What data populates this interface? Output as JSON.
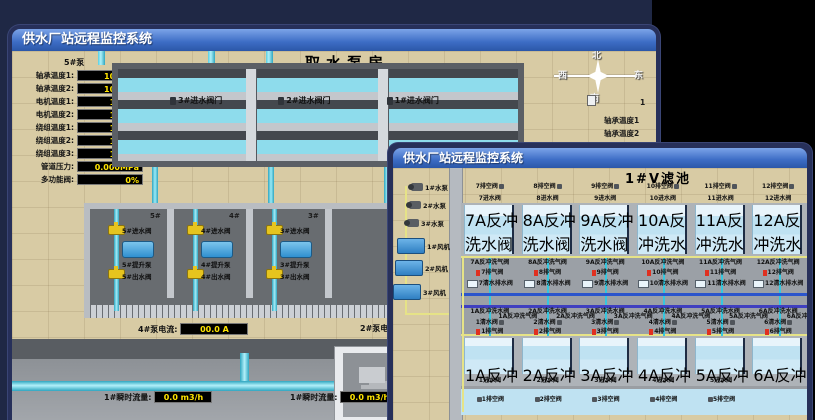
{
  "back_window": {
    "title": "供水厂站远程监控系统",
    "scene_title": "取水泵房",
    "pump_panel": {
      "header": "5#泵",
      "rows": [
        {
          "label": "轴承温度1:",
          "value": "100.0℃"
        },
        {
          "label": "轴承温度2:",
          "value": "100.0℃"
        },
        {
          "label": "电机温度1:",
          "value": "18.1℃"
        },
        {
          "label": "电机温度2:",
          "value": "17.9℃"
        },
        {
          "label": "绕组温度1:",
          "value": "18.0℃"
        },
        {
          "label": "绕组温度2:",
          "value": "18.1℃"
        },
        {
          "label": "绕组温度3:",
          "value": "18.1℃"
        },
        {
          "label": "管道压力:",
          "value": "0.000MPa"
        },
        {
          "label": "多功能阀:",
          "value": "0%"
        }
      ]
    },
    "tank_valves": [
      "3#进水阀门",
      "2#进水阀门",
      "1#进水阀门"
    ],
    "bay_headers": [
      "5#",
      "4#",
      "3#",
      "2#"
    ],
    "bays": [
      {
        "inlet": "5#进水阀",
        "pump": "5#提升泵",
        "outlet": "5#出水阀"
      },
      {
        "inlet": "4#进水阀",
        "pump": "4#提升泵",
        "outlet": "4#出水阀"
      },
      {
        "inlet": "3#进水阀",
        "pump": "3#提升泵",
        "outlet": "3#出水阀"
      }
    ],
    "current": {
      "left_label": "4#泵电流:",
      "left_value": "00.0 A",
      "right_label": "2#泵电流:"
    },
    "flows": [
      {
        "label": "1#瞬时流量:",
        "value": "0.0 m3/h"
      },
      {
        "label": "1#瞬时流量:",
        "value": "0.0 m3/h"
      }
    ],
    "compass": {
      "n": "北",
      "w": "西",
      "s": "南",
      "e": "东"
    },
    "partial_panel": {
      "header": "1",
      "rows": [
        "轴承温度1",
        "轴承温度2"
      ]
    }
  },
  "front_window": {
    "title": "供水厂站远程监控系统",
    "scene_title": "1#V滤池",
    "equipment": {
      "pumps": [
        "1#水泵",
        "2#水泵",
        "3#水泵"
      ],
      "blowers": [
        "1#风机",
        "2#风机",
        "3#风机"
      ]
    },
    "rows": {
      "top_drain": [
        "7排空阀",
        "8排空阀",
        "9排空阀",
        "10排空阀",
        "11排空阀",
        "12排空阀"
      ],
      "top_inlet": [
        "7进水阀",
        "8进水阀",
        "9进水阀",
        "10进水阀",
        "11进水阀",
        "12进水阀"
      ],
      "top_tank_bw": [
        "7A反冲洗水阀",
        "8A反冲洗水阀",
        "9A反冲洗水阀",
        "10A反冲洗水阀",
        "11A反冲洗水阀",
        "12A反冲洗水阀"
      ],
      "top_bw_air": [
        "7A反冲洗气阀",
        "8A反冲洗气阀",
        "9A反冲洗气阀",
        "10A反冲洗气阀",
        "11A反冲洗气阀",
        "12A反冲洗气阀"
      ],
      "top_exhaust": [
        "7排气阀",
        "8排气阀",
        "9排气阀",
        "10排气阀",
        "11排气阀",
        "12排气阀"
      ],
      "top_drainwater": [
        "7清水排水阀",
        "8清水排水阀",
        "9清水排水阀",
        "10清水排水阀",
        "11清水排水阀",
        "12清水排水阀"
      ],
      "bottom_bw_water": [
        "1A反冲洗水阀",
        "2A反冲洗水阀",
        "3A反冲洗水阀",
        "4A反冲洗水阀",
        "5A反冲洗水阀",
        "6A反冲洗水阀"
      ],
      "bottom_clear": [
        "1清水阀",
        "2清水阀",
        "3清水阀",
        "4清水阀",
        "5清水阀",
        "6清水阀"
      ],
      "bottom_bw_air": [
        "1A反冲洗气阀",
        "2A反冲洗气阀",
        "3A反冲洗气阀",
        "4A反冲洗气阀",
        "5A反冲洗气阀",
        "6A反冲洗气阀"
      ],
      "bottom_exhaust": [
        "1排气阀",
        "2排气阀",
        "3排气阀",
        "4排气阀",
        "5排气阀",
        "6排气阀"
      ],
      "bottom_tank_bw": [
        "1A反冲洗水阀",
        "2A反冲洗水阀",
        "3A反冲洗水阀",
        "4A反冲洗水阀",
        "5A反冲洗水阀",
        "6A反冲洗水阀"
      ],
      "bottom_inlet": [
        "1进水阀",
        "2进水阀",
        "3进水阀",
        "4进水阀",
        "5进水阀"
      ],
      "bottom_drain": [
        "1排空阀",
        "2排空阀",
        "3排空阀",
        "4排空阀",
        "5排空阀"
      ]
    }
  },
  "colors": {
    "page_bg": "#1f2845",
    "value_text": "#ffe400",
    "alarm_red": "#e03020",
    "pipe_cyan": "#35c8e0",
    "pipe_blue": "#2b55cc",
    "titlebar_top": "#7ca4e8",
    "titlebar_bottom": "#2b57a8"
  }
}
